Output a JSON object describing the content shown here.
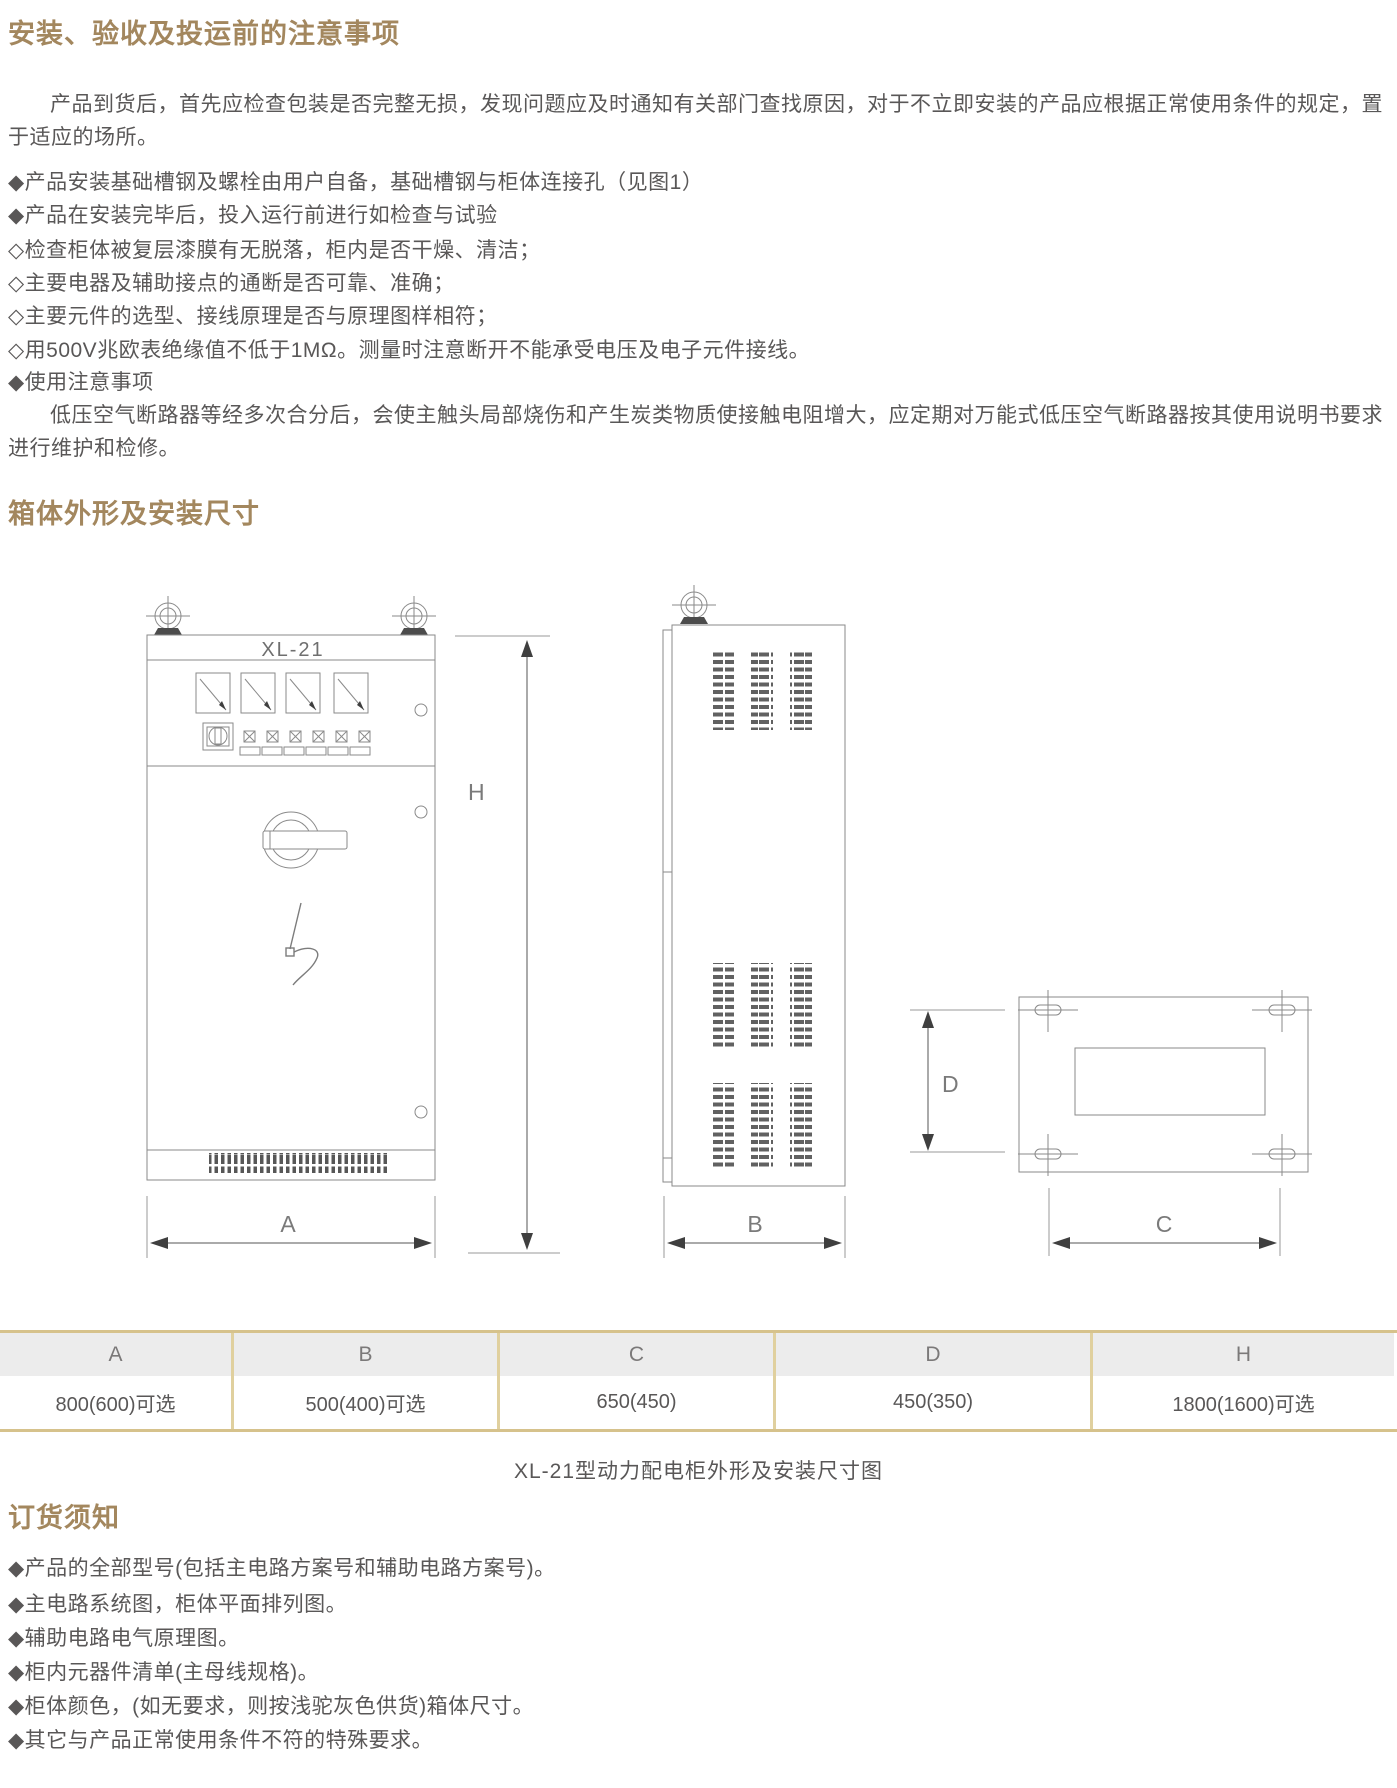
{
  "colors": {
    "heading_gold": "#a3875e",
    "body_text": "#595757",
    "table_gold_border": "#d6c28c",
    "table_header_bg": "#ececec",
    "drawing_line_gray": "#8a8a8a"
  },
  "section_install": {
    "title": "安装、验收及投运前的注意事项",
    "intro": "产品到货后，首先应检查包装是否完整无损，发现问题应及时通知有关部门查找原因，对于不立即安装的产品应根据正常使用条件的规定，置于适应的场所。",
    "items": [
      "◆产品安装基础槽钢及螺栓由用户自备，基础槽钢与柜体连接孔（见图1）",
      "◆产品在安装完毕后，投入运行前进行如检查与试验",
      "◇检查柜体被复层漆膜有无脱落，柜内是否干燥、清洁；",
      "◇主要电器及辅助接点的通断是否可靠、准确；",
      "◇主要元件的选型、接线原理是否与原理图样相符；",
      "◇用500V兆欧表绝缘值不低于1MΩ。测量时注意断开不能承受电压及电子元件接线。",
      "◆使用注意事项"
    ],
    "usage_note": "低压空气断路器等经多次合分后，会使主触头局部烧伤和产生炭类物质使接触电阻增大，应定期对万能式低压空气断路器按其使用说明书要求进行维护和检修。"
  },
  "section_dimensions": {
    "title": "箱体外形及安装尺寸",
    "model_label": "XL-21",
    "dim_a": "A",
    "dim_b": "B",
    "dim_c": "C",
    "dim_d": "D",
    "dim_h": "H",
    "caption": "XL-21型动力配电柜外形及安装尺寸图"
  },
  "table": {
    "columns": [
      "A",
      "B",
      "C",
      "D",
      "H"
    ],
    "values": [
      "800(600)可选",
      "500(400)可选",
      "650(450)",
      "450(350)",
      "1800(1600)可选"
    ]
  },
  "section_order": {
    "title": "订货须知",
    "items": [
      "◆产品的全部型号(包括主电路方案号和辅助电路方案号)。",
      "◆主电路系统图，柜体平面排列图。",
      "◆辅助电路电气原理图。",
      "◆柜内元器件清单(主母线规格)。",
      "◆柜体颜色，(如无要求，则按浅驼灰色供货)箱体尺寸。",
      "◆其它与产品正常使用条件不符的特殊要求。"
    ]
  }
}
